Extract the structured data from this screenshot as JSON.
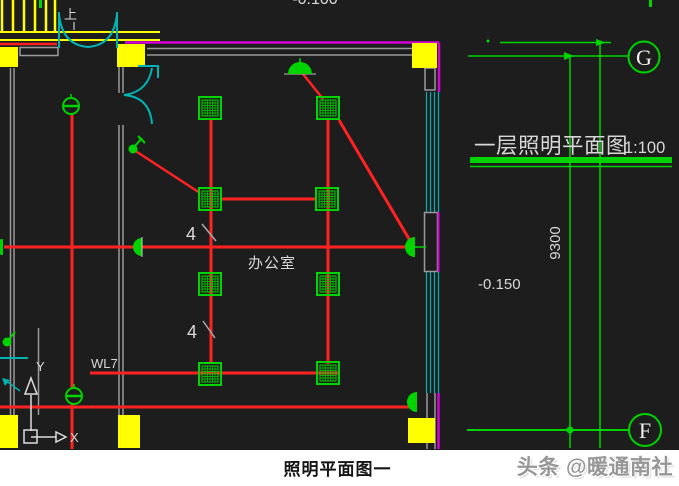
{
  "colors": {
    "background": "#1d1d1d",
    "paper": "#ffffff",
    "wiring_red": "#ff2222",
    "symbol_green": "#00d400",
    "column_yellow": "#ffff00",
    "door_window_cyan": "#00b4b4",
    "wall_magenta": "#d400d4",
    "wall_gray": "#9a9a9a",
    "text_white": "#d8d8d8",
    "caption_black": "#141414",
    "watermark_gray": "#979797"
  },
  "drawing": {
    "plan_title": "一层照明平面图",
    "plan_scale": "1:100",
    "elevation_top": "-0.100",
    "elevation_mid": "-0.150",
    "dimension_vertical": "9300",
    "room_label": "办公室",
    "circuit_label": "WL7",
    "lamp_count_1": "4",
    "lamp_count_2": "4",
    "stair_up_label": "上",
    "grid_axis_g": "G",
    "grid_axis_f": "F",
    "ucs_axis_x": "X",
    "ucs_axis_y": "Y"
  },
  "footer": {
    "caption": "照明平面图一",
    "watermark": "头条 @暖通南社"
  }
}
